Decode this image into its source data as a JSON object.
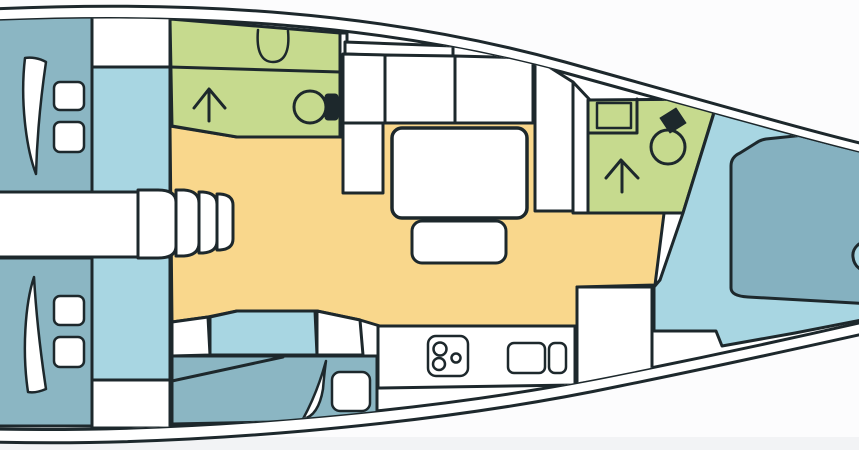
{
  "diagram": {
    "kind": "yacht-interior-floorplan",
    "width": 859,
    "height": 450
  },
  "palette": {
    "line": "#1d282c",
    "white": "#ffffff",
    "teal": "#8bb6c3",
    "bedteal": "#85b1c0",
    "lightblue": "#a8d6e2",
    "green": "#c6da8e",
    "yellow": "#f9d78c",
    "bg": "#fcfcfd",
    "strip": "#f2f3f5"
  },
  "hull": {
    "outer_d": "M-8,9 C190,0 380,11 565,62 C705,101 805,130 872,146 L872,332 C800,348 700,370 620,386 C430,426 180,447 -8,442 Z",
    "inner_d": "M-8,21 C190,13 380,23 562,72 C700,110 802,139 872,156 L872,320 C798,337 696,359 616,375 C430,413 180,433 -8,429 Z"
  },
  "layers": [
    {
      "name": "hull-layer",
      "clip": false,
      "shapes": [
        {
          "name": "hull-outer",
          "t": "path",
          "d": "M-8,9 C190,0 380,11 565,62 C705,101 805,130 872,146 L872,332 C800,348 700,370 620,386 C430,426 180,447 -8,442 Z",
          "f": "white"
        },
        {
          "name": "hull-inner-deck",
          "t": "path",
          "d": "M-8,21 C190,13 380,23 562,72 C700,110 802,139 872,156 L872,320 C798,337 696,359 616,375 C430,413 180,433 -8,429 Z",
          "f": "white"
        }
      ]
    },
    {
      "name": "interior-layer",
      "clip": true,
      "shapes": [
        {
          "name": "saloon-floor",
          "t": "polygon",
          "pts": "170,126 237,137 340,137 340,118 676,118 655,285 577,287 577,326 380,326 360,320 317,311 237,311 208,317 172,322",
          "f": "yellow"
        },
        {
          "name": "aft-cabin-port",
          "t": "rect",
          "x": -8,
          "y": 14,
          "w": 100,
          "h": 178,
          "f": "teal"
        },
        {
          "name": "aft-cabin-port-door-arc",
          "t": "path",
          "d": "M25,58 C20,100 26,148 36,174 C37,138 41,96 46,62 C39,58 31,57 25,58 Z",
          "f": "white",
          "sw": 2.5
        },
        {
          "name": "aft-cabin-port-pillow-1",
          "t": "rect",
          "x": 54,
          "y": 82,
          "w": 30,
          "h": 28,
          "rx": 6,
          "f": "white",
          "sw": 2.5
        },
        {
          "name": "aft-cabin-port-pillow-2",
          "t": "rect",
          "x": 54,
          "y": 122,
          "w": 30,
          "h": 30,
          "rx": 6,
          "f": "white",
          "sw": 2.5
        },
        {
          "name": "wardrobe-top",
          "t": "rect",
          "x": 92,
          "y": 14,
          "w": 78,
          "h": 53,
          "f": "white"
        },
        {
          "name": "passage-panel-top",
          "t": "rect",
          "x": 92,
          "y": 67,
          "w": 78,
          "h": 125,
          "f": "lightblue"
        },
        {
          "name": "aft-cabin-starboard",
          "t": "rect",
          "x": -8,
          "y": 258,
          "w": 100,
          "h": 168,
          "f": "teal"
        },
        {
          "name": "aft-cabin-starboard-door-arc",
          "t": "path",
          "d": "M28,392 C22,352 25,304 34,277 C36,312 41,356 46,389 C39,392 33,393 28,392 Z",
          "f": "white",
          "sw": 2.5
        },
        {
          "name": "aft-cabin-starboard-pillow-1",
          "t": "rect",
          "x": 54,
          "y": 296,
          "w": 30,
          "h": 29,
          "rx": 6,
          "f": "white",
          "sw": 2.5
        },
        {
          "name": "aft-cabin-starboard-pillow-2",
          "t": "rect",
          "x": 54,
          "y": 337,
          "w": 30,
          "h": 30,
          "rx": 6,
          "f": "white",
          "sw": 2.5
        },
        {
          "name": "passage-panel-bottom",
          "t": "rect",
          "x": 92,
          "y": 257,
          "w": 78,
          "h": 123,
          "f": "lightblue"
        },
        {
          "name": "wardrobe-bottom",
          "t": "rect",
          "x": 92,
          "y": 380,
          "w": 78,
          "h": 48,
          "f": "white"
        },
        {
          "name": "companionway-band",
          "t": "rect",
          "x": -8,
          "y": 192,
          "w": 146,
          "h": 65,
          "f": "white"
        },
        {
          "name": "companionway-landing",
          "t": "path",
          "d": "M138,190 L158,190 Q176,190 176,202 L176,246 Q176,258 158,258 L138,258 Z",
          "f": "white"
        },
        {
          "name": "companionway-step-1",
          "t": "path",
          "d": "M176,190 h8 q15,1 15,13 v40 q0,12 -15,13 h-8 z",
          "f": "white"
        },
        {
          "name": "companionway-step-2",
          "t": "path",
          "d": "M199,192 h4 q14,1 14,12 v37 q0,11 -14,12 h-4 z",
          "f": "white"
        },
        {
          "name": "companionway-step-3",
          "t": "path",
          "d": "M217,194 h3 q13,1 13,11 v34 q0,10 -13,11 h-3 z",
          "f": "white"
        },
        {
          "name": "head-aft",
          "t": "polygon",
          "pts": "170,19 340,33 340,137 237,137 172,126",
          "f": "green"
        },
        {
          "name": "head-aft-counter-line",
          "t": "line",
          "x1": 170,
          "y1": 67,
          "x2": 340,
          "y2": 72,
          "f": null
        },
        {
          "name": "head-aft-sink",
          "t": "path",
          "d": "M258,30 C256,52 262,62 273,62 C284,62 290,52 288,31",
          "f": null,
          "sw": 2.5
        },
        {
          "name": "head-aft-shower-arrow-stem",
          "t": "line",
          "x1": 209,
          "y1": 91,
          "x2": 209,
          "y2": 121,
          "f": null
        },
        {
          "name": "head-aft-shower-arrow-head",
          "t": "polyline",
          "pts": "194,108 209,89 225,108",
          "f": null
        },
        {
          "name": "head-aft-toilet-bowl",
          "t": "circle",
          "cx": 310,
          "cy": 107,
          "r": 16,
          "f": "green"
        },
        {
          "name": "head-aft-toilet-tank",
          "t": "rect",
          "x": 325,
          "y": 94,
          "w": 13,
          "h": 26,
          "rx": 3,
          "f": "line",
          "sw": 1
        },
        {
          "name": "partition-strip",
          "t": "rect",
          "x": 340,
          "y": 33,
          "w": 7,
          "h": 104,
          "f": "white"
        },
        {
          "name": "settee-backrest-1",
          "t": "polygon",
          "pts": "345,42 453,46 453,58 345,54",
          "f": "white"
        },
        {
          "name": "settee-backrest-2",
          "t": "polygon",
          "pts": "453,46 533,50 533,58 453,58",
          "f": "white"
        },
        {
          "name": "settee-seat-1",
          "t": "polygon",
          "pts": "343,54 385,55 385,123 343,123",
          "f": "white"
        },
        {
          "name": "settee-seat-2",
          "t": "polygon",
          "pts": "385,55 455,56 455,123 385,123",
          "f": "white"
        },
        {
          "name": "settee-seat-3",
          "t": "polygon",
          "pts": "455,56 533,58 533,123 455,123",
          "f": "white"
        },
        {
          "name": "settee-end-seat",
          "t": "rect",
          "x": 343,
          "y": 123,
          "w": 40,
          "h": 70,
          "f": "white"
        },
        {
          "name": "settee-chaise",
          "t": "polygon",
          "pts": "535,58 573,82 573,211 535,211",
          "f": "white"
        },
        {
          "name": "corridor-fwd",
          "t": "polygon",
          "pts": "573,82 590,100 590,213 573,213",
          "f": "white"
        },
        {
          "name": "saloon-table",
          "t": "rect",
          "x": 392,
          "y": 128,
          "w": 135,
          "h": 90,
          "rx": 10,
          "f": "white",
          "sw": 3.5
        },
        {
          "name": "saloon-bench",
          "t": "rect",
          "x": 412,
          "y": 221,
          "w": 94,
          "h": 42,
          "rx": 10,
          "f": "white"
        },
        {
          "name": "head-fwd",
          "t": "polygon",
          "pts": "588,100 718,99 683,213 588,213",
          "f": "green"
        },
        {
          "name": "head-fwd-counter-line",
          "t": "polyline",
          "pts": "588,133 637,133 637,99",
          "f": null
        },
        {
          "name": "head-fwd-sink",
          "t": "rect",
          "x": 597,
          "y": 103,
          "w": 34,
          "h": 25,
          "f": null,
          "sw": 2.5
        },
        {
          "name": "head-fwd-toilet-bowl",
          "t": "circle",
          "cx": 668,
          "cy": 147,
          "r": 17,
          "f": "green"
        },
        {
          "name": "head-fwd-toilet-tank",
          "t": "polygon",
          "pts": "660,118 676,108 686,123 670,133",
          "f": "line",
          "sw": 1
        },
        {
          "name": "head-fwd-shower-arrow-stem",
          "t": "line",
          "x1": 622,
          "y1": 162,
          "x2": 622,
          "y2": 192,
          "f": null
        },
        {
          "name": "head-fwd-shower-arrow-head",
          "t": "polyline",
          "pts": "606,178 621,160 638,178",
          "f": null
        },
        {
          "name": "fwd-cabin-floor",
          "t": "polygon",
          "pts": "718,112 872,152 872,318 795,333 722,346 716,331 654,331 654,287 660,280 683,213 718,100",
          "f": "lightblue"
        },
        {
          "name": "nav-desk",
          "t": "polygon",
          "pts": "577,287 652,287 652,371 577,384",
          "f": "white"
        },
        {
          "name": "fwd-island-bed",
          "t": "path",
          "d": "M731,166 Q731,157 740,153 L756,143 Q760,140 766,139 L872,128 L872,240 C858,241 852,249 853,257 C854,267 862,272 872,273 L872,304 L748,297 Q731,296 731,288 Z",
          "f": "bedteal"
        },
        {
          "name": "galley-counter",
          "t": "polygon",
          "pts": "378,326 575,326 575,385 378,388",
          "f": "white"
        },
        {
          "name": "galley-stove",
          "t": "rect",
          "x": 428,
          "y": 336,
          "w": 40,
          "h": 40,
          "rx": 8,
          "f": "white",
          "sw": 2.5
        },
        {
          "name": "galley-burner-1",
          "t": "circle",
          "cx": 440,
          "cy": 349,
          "r": 6.5,
          "f": "white",
          "sw": 2.5
        },
        {
          "name": "galley-burner-2",
          "t": "circle",
          "cx": 439,
          "cy": 364,
          "r": 6,
          "f": "white",
          "sw": 2.5
        },
        {
          "name": "galley-burner-3",
          "t": "circle",
          "cx": 456,
          "cy": 358,
          "r": 4.5,
          "f": "white",
          "sw": 2.5
        },
        {
          "name": "galley-sink-1",
          "t": "rect",
          "x": 508,
          "y": 343,
          "w": 37,
          "h": 30,
          "rx": 6,
          "f": "white",
          "sw": 2.5
        },
        {
          "name": "galley-sink-2",
          "t": "rect",
          "x": 549,
          "y": 343,
          "w": 17,
          "h": 30,
          "rx": 6,
          "f": "white",
          "sw": 2.5
        },
        {
          "name": "side-seat-left",
          "t": "polygon",
          "pts": "172,322 208,317 210,355 172,356",
          "f": "white"
        },
        {
          "name": "side-locker-blue",
          "t": "polygon",
          "pts": "210,317 237,311 315,311 317,355 210,355",
          "f": "lightblue"
        },
        {
          "name": "side-seat-right",
          "t": "polygon",
          "pts": "317,311 360,320 363,355 317,355",
          "f": "white"
        },
        {
          "name": "side-berth",
          "t": "polygon",
          "pts": "172,356 377,356 377,420 172,424",
          "f": "teal"
        },
        {
          "name": "side-berth-backrest-line",
          "t": "line",
          "x1": 172,
          "y1": 381,
          "x2": 283,
          "y2": 357,
          "f": null
        },
        {
          "name": "side-berth-door-arc",
          "t": "path",
          "d": "M326,361 C318,390 309,408 303,419 C313,417 320,407 323,389 C324,377 325,368 326,361 Z",
          "f": "white",
          "sw": 2.5
        },
        {
          "name": "side-berth-pillow",
          "t": "rect",
          "x": 332,
          "y": 372,
          "w": 38,
          "h": 39,
          "rx": 8,
          "f": "white",
          "sw": 2.5
        }
      ]
    }
  ]
}
